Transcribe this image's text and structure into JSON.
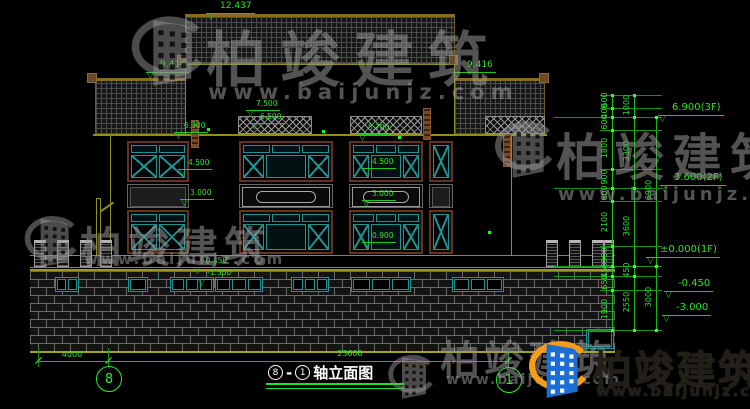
{
  "watermark": {
    "brand": "柏竣建筑",
    "url": "www.baijunjz.com"
  },
  "drawing_title": {
    "axis_left": "8",
    "separator": "-",
    "axis_right": "1",
    "label": "轴立面图"
  },
  "axis_bubbles": {
    "left": "8",
    "right": "1"
  },
  "bottom_dimensions": {
    "segment_left": "4000",
    "segment_total": "23600"
  },
  "facade_elevations": {
    "ridge": "12.437",
    "eave_left": "9.416",
    "eave_right": "9.416",
    "parapet": "7.500",
    "band": "6.500",
    "left_head": "6.300",
    "head_2f": "5.700",
    "sill_2f_left": "4.500",
    "sill_2f_mid": "4.500",
    "head_1f_left": "3.000",
    "head_1f_mid": "3.000",
    "sill_1f": "0.900",
    "podium": "-0.450",
    "basement": "-1.350"
  },
  "level_markers": {
    "f3": "6.900(3F)",
    "f2": "3.600(2F)",
    "f1": "±0.000(1F)",
    "minus045": "-0.450",
    "minus300": "-3.000"
  },
  "dim_chains": {
    "inner": [
      "600",
      "400",
      "600",
      "1800",
      "900",
      "600",
      "2100",
      "900",
      "450",
      "650",
      "1900"
    ],
    "mid": [
      "1000",
      "3300",
      "3600",
      "450",
      "2550"
    ],
    "outer": [
      "6900",
      "3000"
    ]
  }
}
